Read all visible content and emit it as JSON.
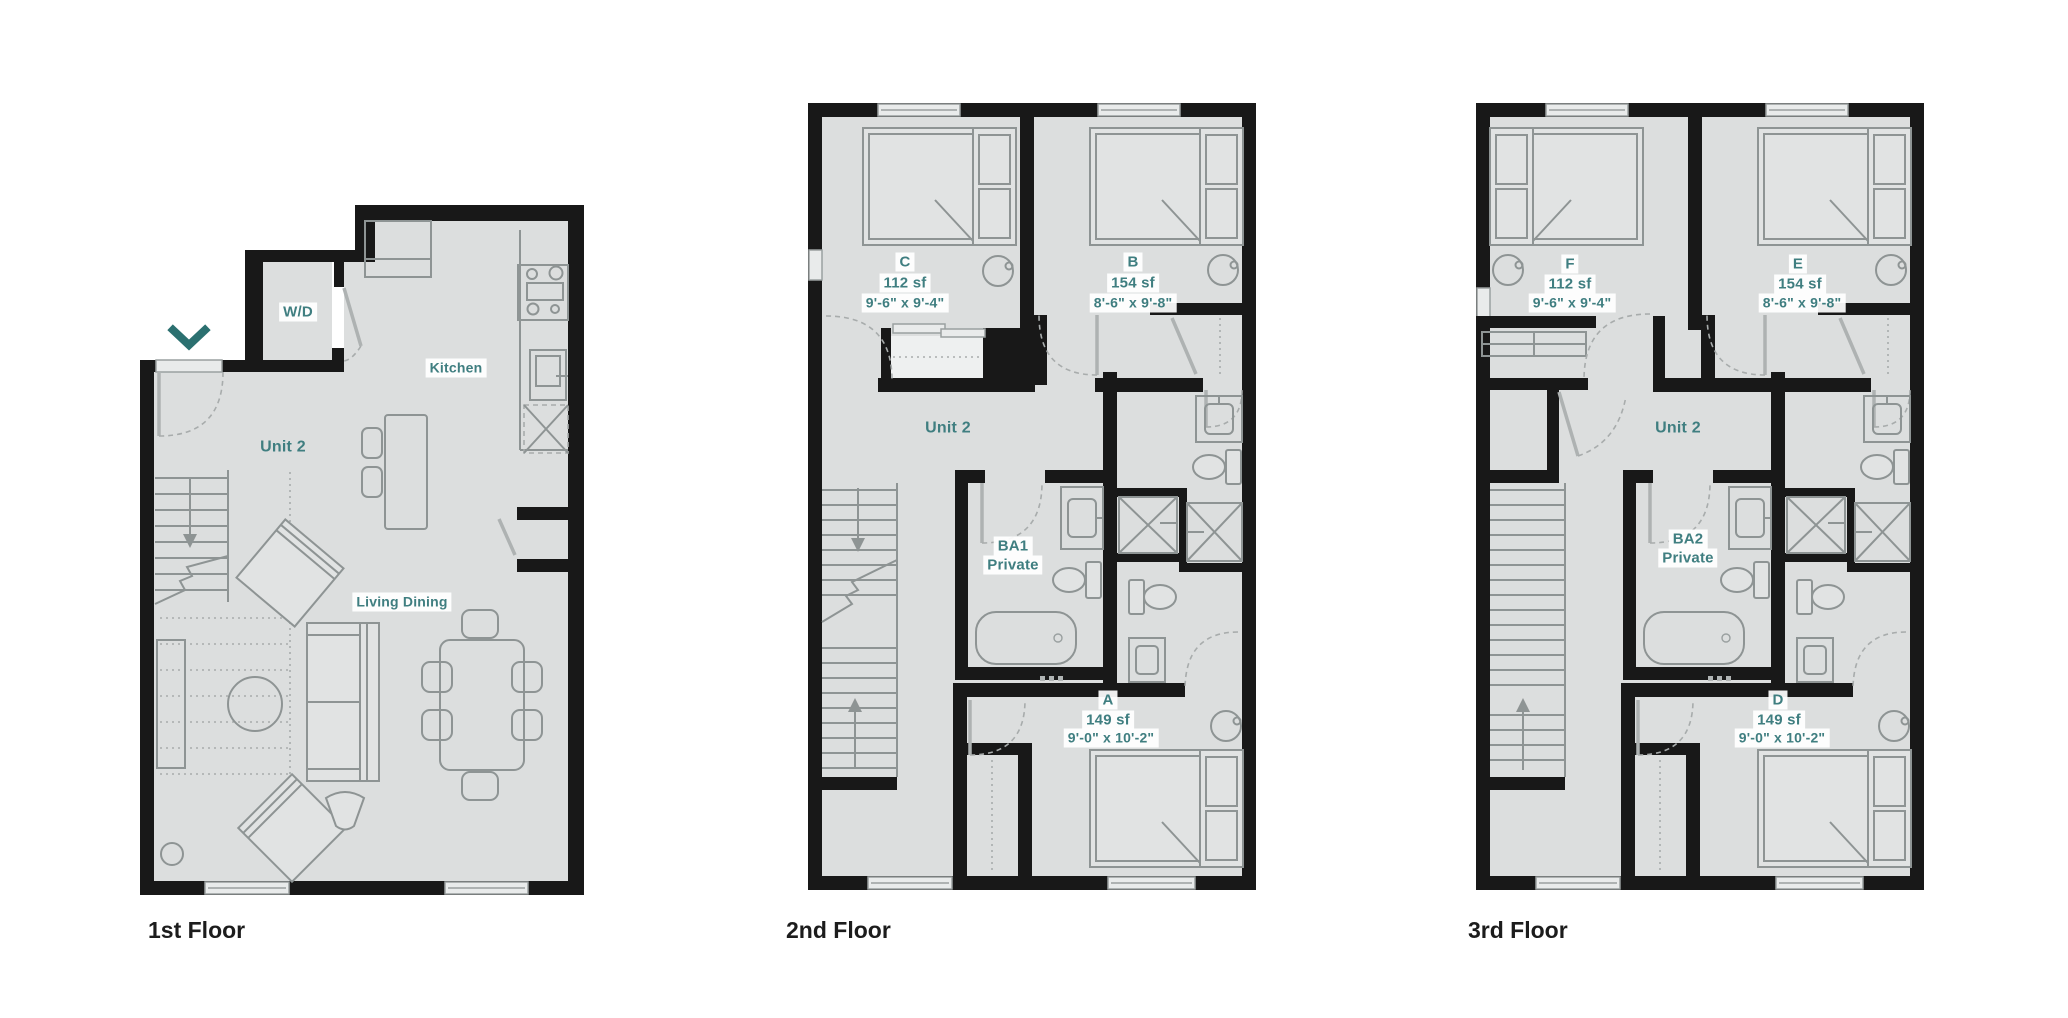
{
  "sheet": {
    "type": "multi-floor residential floor plan",
    "background": "#ffffff"
  },
  "colors": {
    "wall": "#181818",
    "room_fill": "#dcdede",
    "furniture_stroke": "#8e9494",
    "label_teal": "#3f7e80",
    "entry_marker_teal": "#2b7070",
    "caption_black": "#1c1c1c"
  },
  "icons": {
    "entry_chevron": "chevron-down"
  },
  "floors": [
    {
      "caption": "1st Floor",
      "rooms": {
        "unit": "Unit 2",
        "wd": "W/D",
        "kitchen": "Kitchen",
        "living": "Living Dining"
      }
    },
    {
      "caption": "2nd Floor",
      "unit_label": "Unit 2",
      "bath": {
        "line1": "BA1",
        "line2": "Private"
      },
      "bedrooms": [
        {
          "name": "C",
          "area": "112 sf",
          "dims": "9'-6\" x 9'-4\""
        },
        {
          "name": "B",
          "area": "154 sf",
          "dims": "8'-6\" x 9'-8\""
        },
        {
          "name": "A",
          "area": "149 sf",
          "dims": "9'-0\" x 10'-2\""
        }
      ]
    },
    {
      "caption": "3rd Floor",
      "unit_label": "Unit 2",
      "bath": {
        "line1": "BA2",
        "line2": "Private"
      },
      "bedrooms": [
        {
          "name": "F",
          "area": "112 sf",
          "dims": "9'-6\" x 9'-4\""
        },
        {
          "name": "E",
          "area": "154 sf",
          "dims": "8'-6\" x 9'-8\""
        },
        {
          "name": "D",
          "area": "149 sf",
          "dims": "9'-0\" x 10'-2\""
        }
      ]
    }
  ]
}
